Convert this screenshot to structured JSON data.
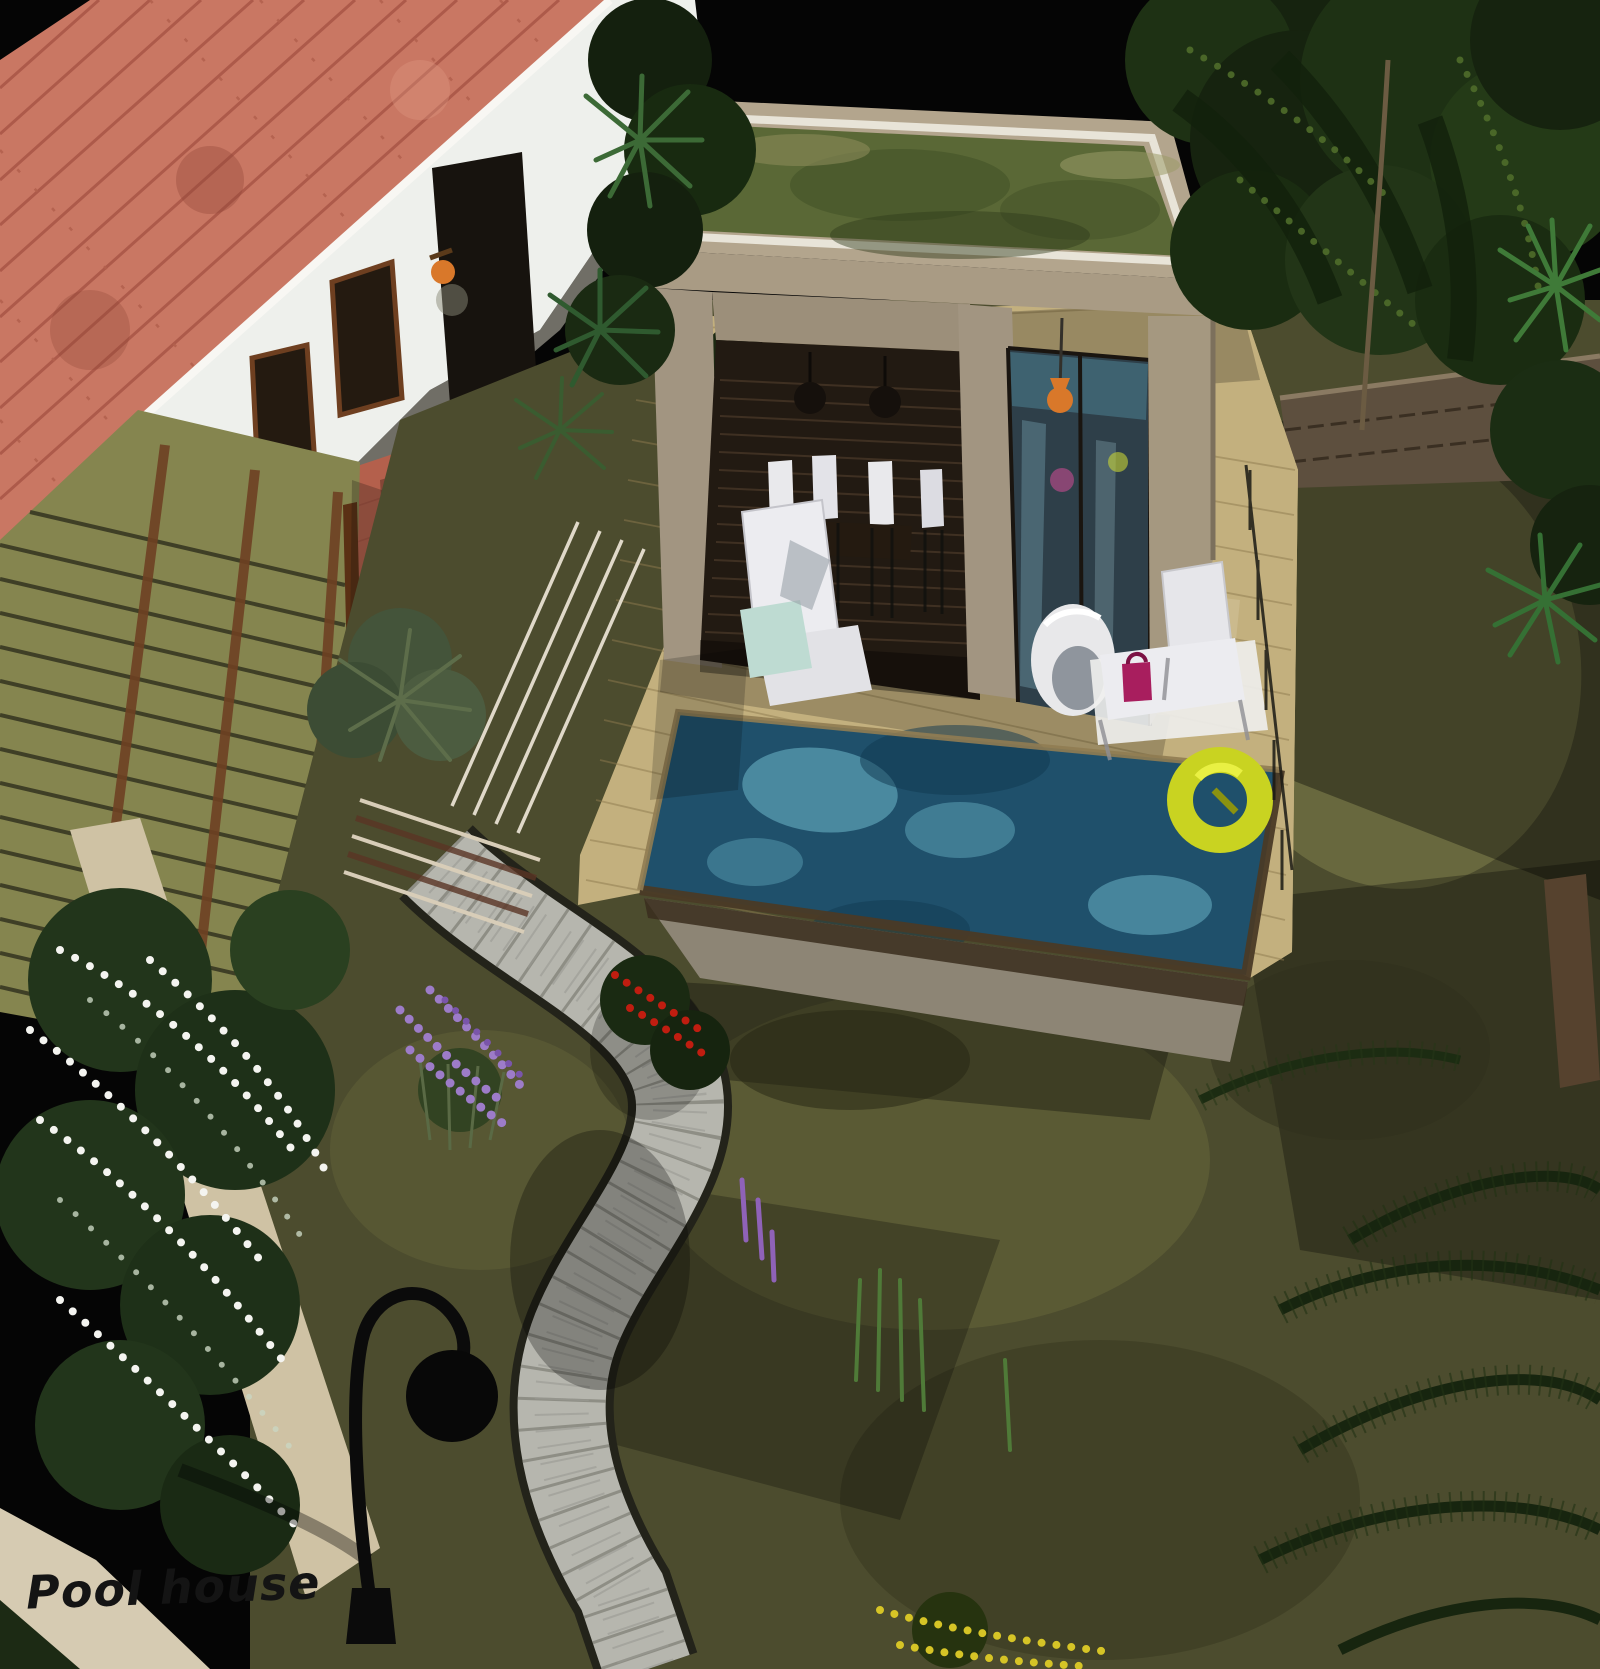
{
  "scene": {
    "caption": "Pool house",
    "description": "3D architectural rendering: aerial night view of a villa garden with a flat green-roofed pool house, swimming pool with yellow float ring, wooden deck, tiled-roof main house, pergola, cobblestone path, street lamp and flowering garden",
    "objects": [
      "main-house",
      "terracotta-tile-roof",
      "white-wall",
      "wall-lantern",
      "pergola",
      "brick-terrace",
      "terrace-steps",
      "wooden-deck",
      "deck-railing",
      "planter",
      "pool-house",
      "green-living-roof",
      "dining-set",
      "pendant-lamps",
      "glass-door",
      "orange-pendant-lamp",
      "swimming-pool",
      "yellow-float-ring",
      "lounge-chair",
      "egg-chair",
      "sun-lounger",
      "teal-towel",
      "magenta-bag",
      "garden-lawn",
      "cobblestone-path",
      "street-lamp",
      "stone-wall",
      "retaining-wall",
      "white-flower-shrub",
      "lavender-flowers",
      "red-flowers",
      "purple-spike-flowers",
      "yellow-flowers",
      "trees",
      "palm-fronds",
      "yucca-plants"
    ],
    "palette": {
      "sky": "#050505",
      "roof_tiles": "#c97763",
      "roof_tile_joint": "#a65243",
      "house_wall": "#eef0ec",
      "pergola_slats": "#85854f",
      "pergola_beam": "#6e4022",
      "terrace_brick": "#b4604c",
      "deck_wood": "#c3b07e",
      "pool_water": "#1f506b",
      "pool_highlight": "#7ecfe0",
      "float_ring": "#c9d321",
      "grass": "#4c4c2e",
      "path_stone": "#b6b6ae",
      "pool_house_wall": "#a99b84",
      "green_roof": "#5a6836",
      "glass": "#2e3f49",
      "accent_orange": "#d9782a",
      "magenta_bag": "#a81e5e",
      "towel_teal": "#bedbd2",
      "lamp_black": "#0b0b0b",
      "stone_wall": "#5d4f3e",
      "flowers_white": "#f4f4f0",
      "flowers_lavender": "#9d7cc8",
      "flowers_red": "#c01d10",
      "flowers_yellow": "#d6c426"
    }
  }
}
